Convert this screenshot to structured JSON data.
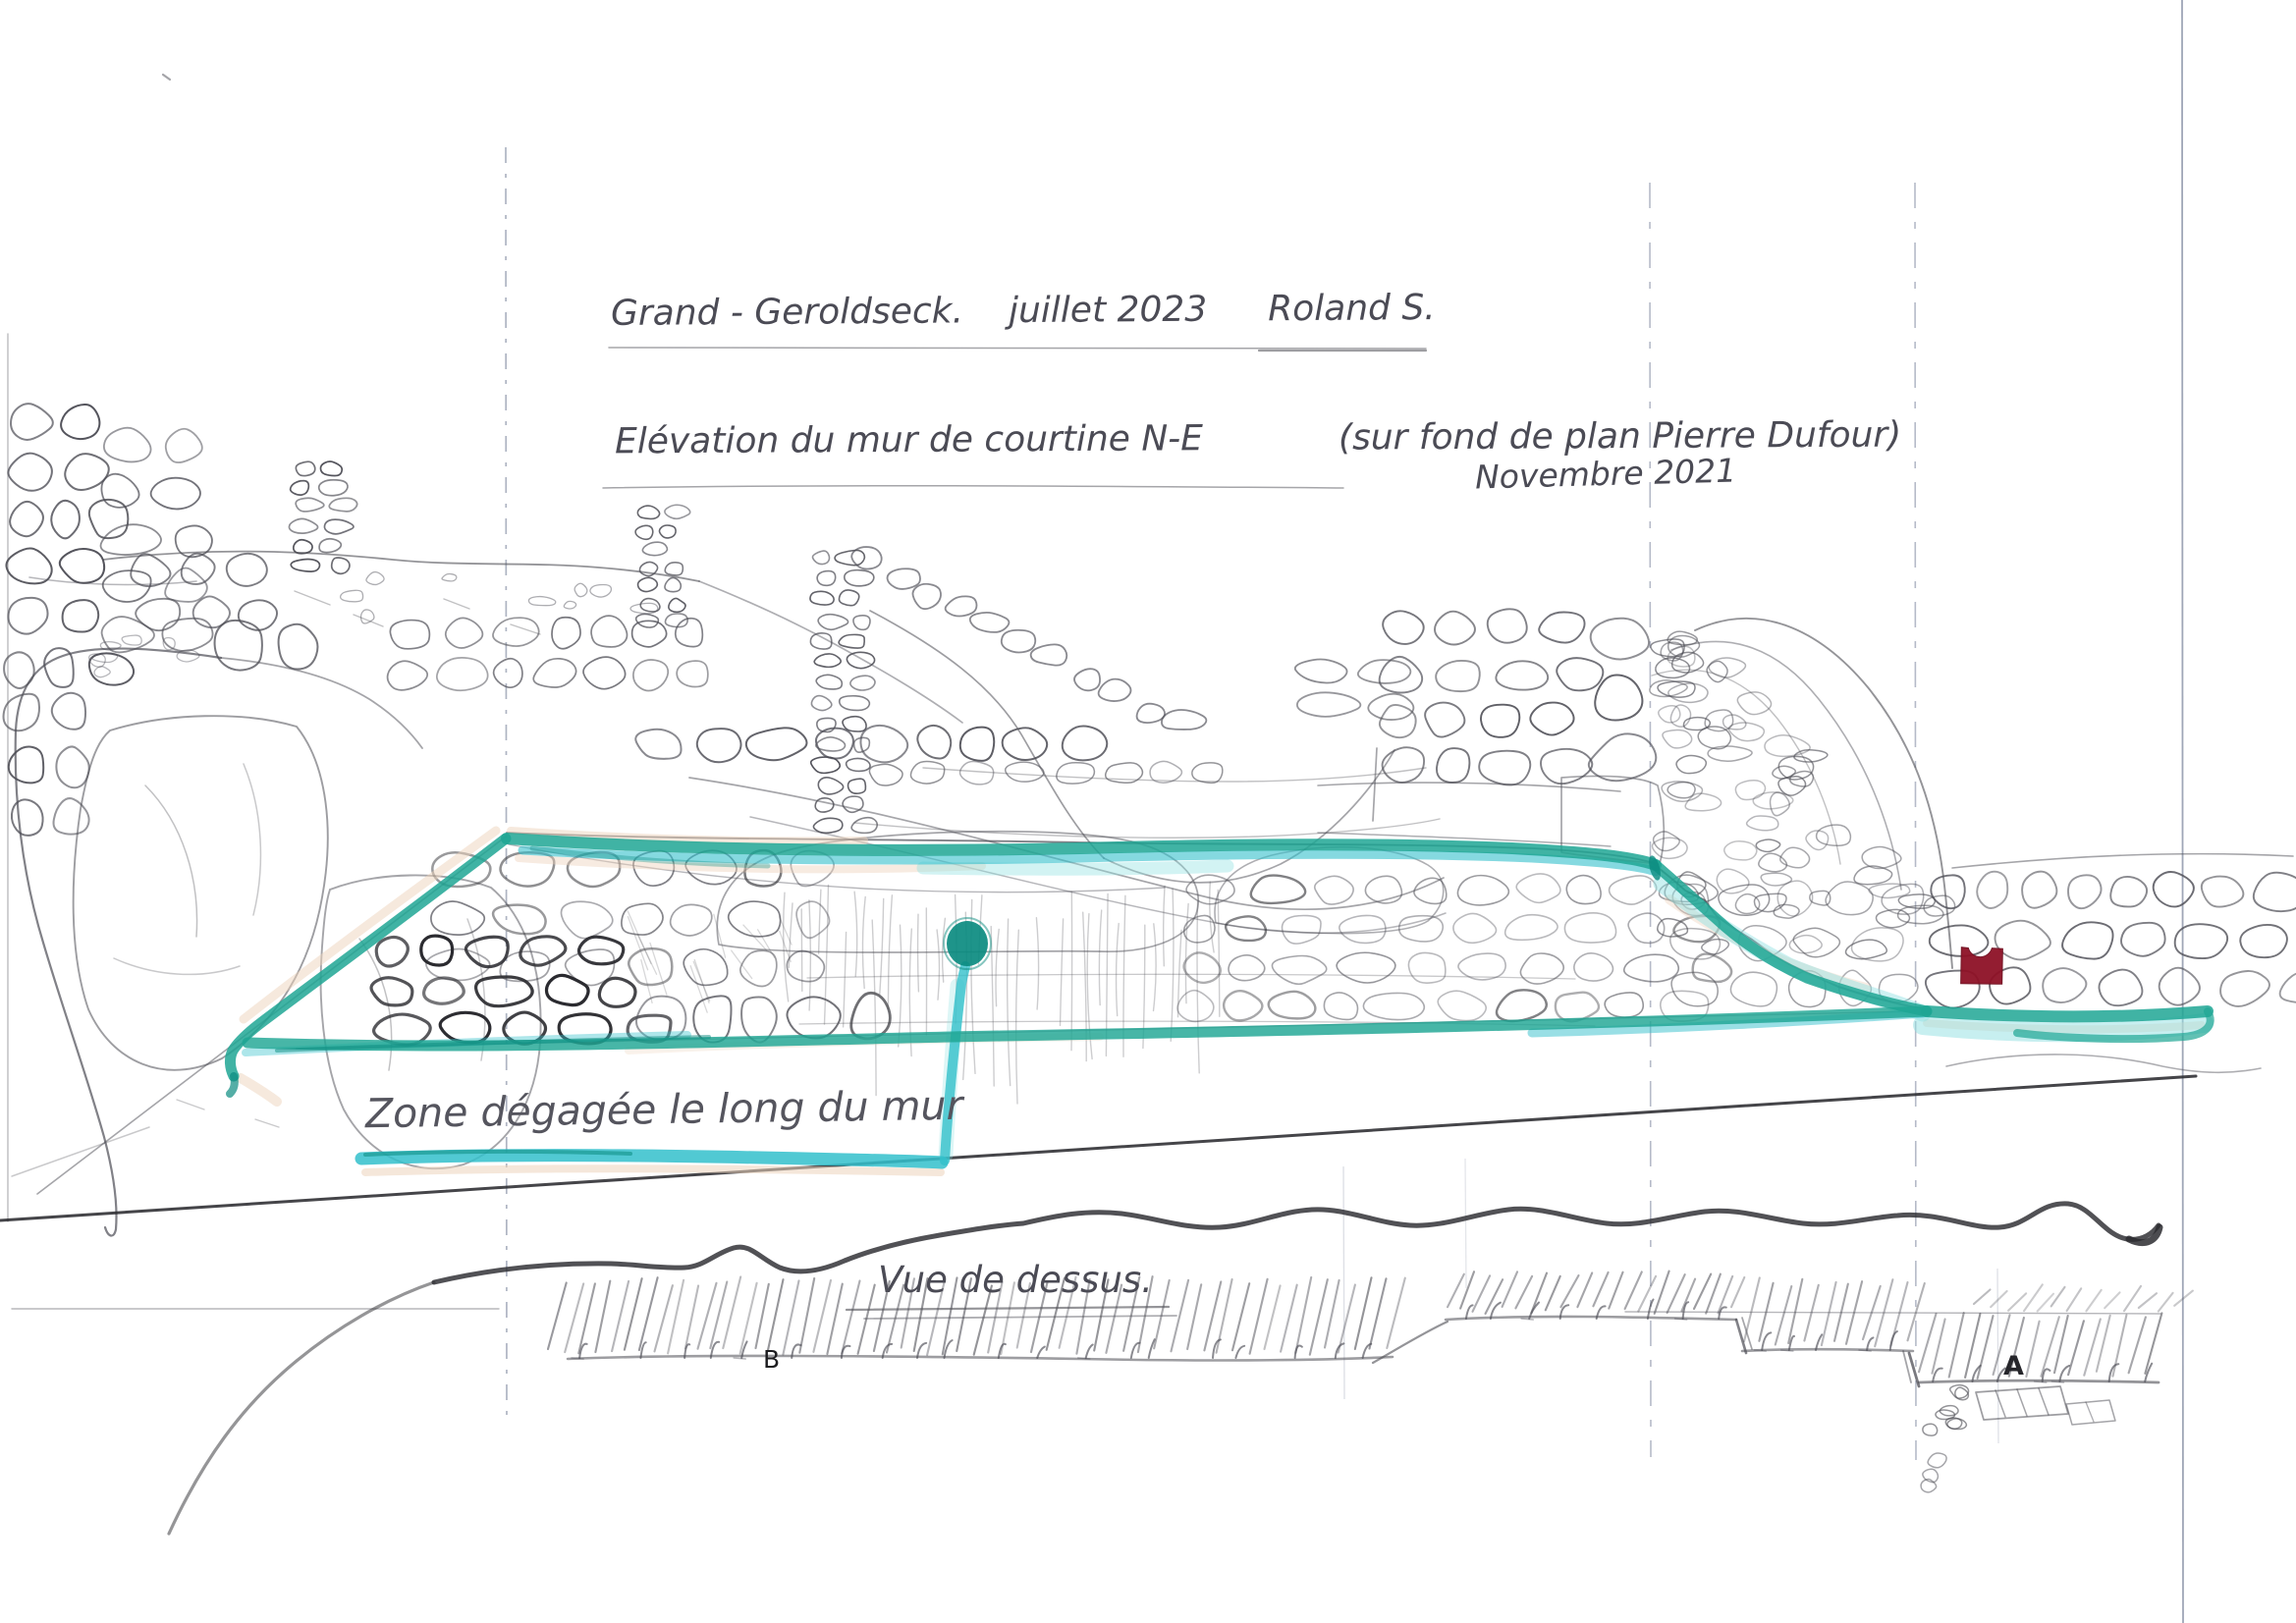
{
  "title": {
    "site": "Grand - Geroldseck.",
    "date": "juillet 2023",
    "author": "Roland S."
  },
  "subtitle": {
    "text": "Elévation du mur de courtine N-E",
    "source": "(sur fond de plan Pierre Dufour)",
    "source_date": "Novembre 2021"
  },
  "labels": {
    "zone": "Zone dégagée le long du mur",
    "top_view": "Vue de dessus.",
    "marker_a": "A",
    "marker_b": "B"
  },
  "colors": {
    "teal_green": "#1fa694",
    "teal_cyan": "#33c0cb",
    "teal_dark": "#0b8b80",
    "teal_light": "#8fe0e2",
    "shadow_tan": "#edd3bc",
    "marker_red": "#8e1126",
    "pencil": "#4c4c54",
    "ink": "#2b2b30",
    "construction": "#6d7892",
    "paper": "#ffffff"
  }
}
